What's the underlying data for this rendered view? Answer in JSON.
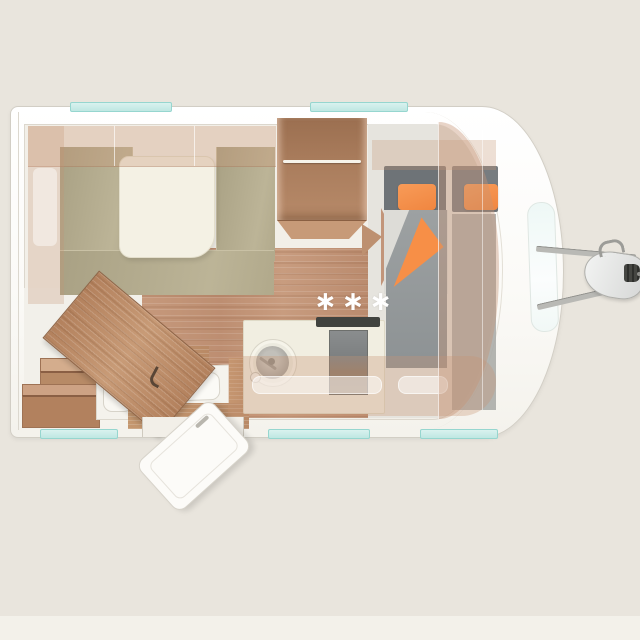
{
  "scene": {
    "type": "caravan floor plan, top-down 3D render",
    "heater_symbol": "∗∗∗"
  },
  "colors": {
    "background": "#e9e5dd",
    "shell_white": "#fdfdfb",
    "window_teal": "#cdecea",
    "wood_floor": "#c2957a",
    "furniture_wood": "#bf9270",
    "seat_olive": "#b3ab8d",
    "table_cream": "#f4f1e4",
    "counter_cream": "#f1eee1",
    "cooktop_gray": "#7c7f80",
    "mattress_gray": "#9a9e9f",
    "headboard_gray": "#6e7377",
    "pillow_orange": "#f6924c",
    "overlay_tan": "rgba(199,148,116,0.35)"
  }
}
